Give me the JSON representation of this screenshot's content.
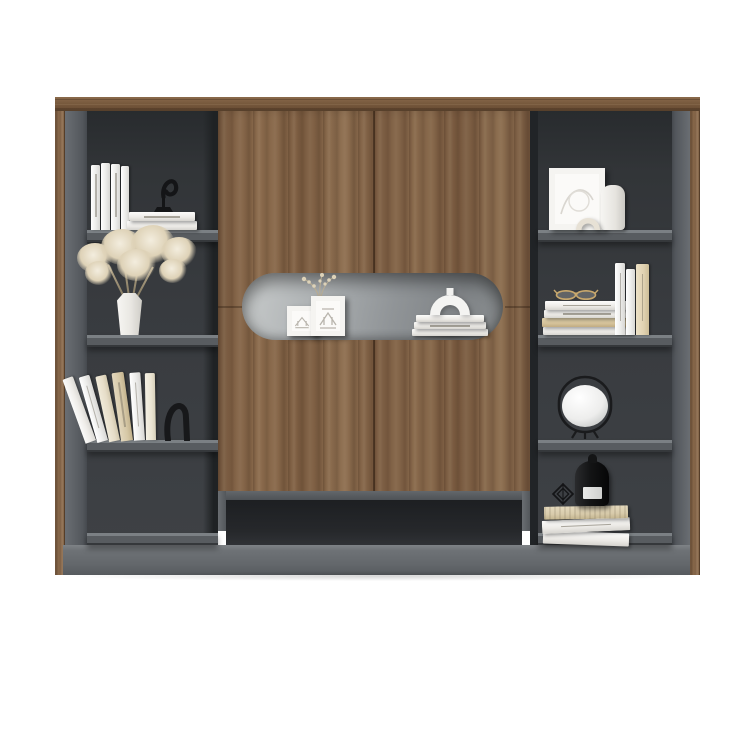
{
  "scene": {
    "kind": "furniture product photo",
    "background": "#ffffff",
    "subject": "bookshelf wall unit with walnut sliding-door cabinet and gray open shelving"
  },
  "palette": {
    "walnut": "#82634a",
    "walnut_dark": "#6d5138",
    "walnut_light": "#937453",
    "side_gray": "#5b5f64",
    "interior_dark": "#383b3f",
    "shelf_gray": "#5c6064",
    "plinth_gray": "#63676b",
    "niche_light": "#c9cccc",
    "niche_dark": "#7f8386",
    "decor_white": "#f3f2ef",
    "decor_cream": "#ddd1b6",
    "decor_black": "#17181a",
    "brass": "#c8a86d"
  },
  "furniture": {
    "name": "Modern walnut and gray bookshelf wall unit",
    "top_panel_label": "walnut top panel",
    "left_stile_label": "walnut left edge",
    "right_stile_label": "walnut right edge",
    "plinth_label": "gray plinth base",
    "center": {
      "label": "walnut sliding-door cabinet",
      "doors_label": "two walnut sliding doors",
      "niche_label": "recessed oval display niche",
      "open_base_label": "open compartment under doors",
      "niche_items": [
        {
          "name": "mini-framed-prints",
          "label": "two small white framed architectural prints"
        },
        {
          "name": "dried-sprigs",
          "label": "dried flower sprigs"
        },
        {
          "name": "white-book-stack",
          "label": "stack of white books"
        },
        {
          "name": "arch-sculpture",
          "label": "white arch sculpture"
        }
      ]
    },
    "left_column": {
      "label": "left open shelf column",
      "shelves": [
        {
          "label": "four upright white books, two stacked books and a black hook sculpture"
        },
        {
          "label": "white faceted vase with dried flowers"
        },
        {
          "label": "row of leaning books with a black curved bookend"
        },
        {
          "label": "empty shelf"
        }
      ]
    },
    "right_column": {
      "label": "right open shelf column",
      "shelves": [
        {
          "label": "white framed line art, cylinder vase and cream arch object"
        },
        {
          "label": "stack of four books with gold glasses and three upright books"
        },
        {
          "label": "white globe lamp in a black wire frame"
        },
        {
          "label": "tilted stack of books with a black bell candle jar and wire ornament"
        }
      ]
    }
  }
}
